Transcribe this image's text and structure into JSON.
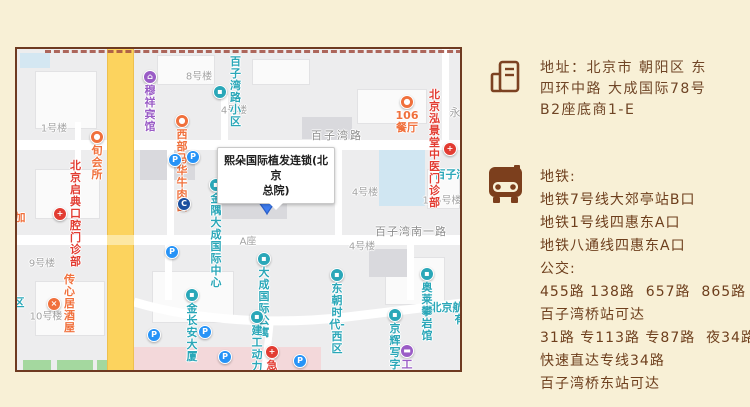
{
  "map": {
    "callout": {
      "line1": "熙朵国际植发连锁(北京",
      "line2": "总院)"
    },
    "pin_label": "1",
    "pois": [
      {
        "name": "muxiang-hotel",
        "icon": "hotel-icon",
        "glyph": "⌂",
        "color": "#9a5cc6",
        "x": 133,
        "y": 28,
        "label": "穆祥宾馆",
        "label_pos": "below",
        "label_color": "#9a5cc6"
      },
      {
        "name": "baiziwanlu-xiaoqu",
        "icon": "residence-icon",
        "glyph": "▪",
        "color": "#2aa7b8",
        "x": 203,
        "y": 43,
        "label": "百子湾路小区",
        "label_pos": "right",
        "label_color": "#2aa7b8"
      },
      {
        "name": "restaurant-106",
        "icon": "restaurant-icon",
        "glyph": "●",
        "color": "#f0703c",
        "x": 390,
        "y": 53,
        "label": "106餐厅",
        "label_pos": "below",
        "label_color": "#f0703c"
      },
      {
        "name": "xibu-mahua-noodle",
        "icon": "restaurant-icon",
        "glyph": "●",
        "color": "#f0703c",
        "x": 165,
        "y": 72,
        "label": "西部马华牛肉面",
        "label_pos": "below",
        "label_color": "#f0703c"
      },
      {
        "name": "xun-club",
        "icon": "leisure-icon",
        "glyph": "●",
        "color": "#f0703c",
        "x": 80,
        "y": 88,
        "label": "旬会所",
        "label_pos": "below",
        "label_color": "#f0703c"
      },
      {
        "name": "hongjingtang-clinic",
        "icon": "hospital-icon",
        "glyph": "+",
        "color": "#e23c32",
        "x": 433,
        "y": 100,
        "label": "北京泓景堂\n中医门诊部",
        "label_pos": "left",
        "label_color": "#e23c32"
      },
      {
        "name": "jinyu-dacheng-center",
        "icon": "mall-icon",
        "glyph": "▪",
        "color": "#2aa7b8",
        "x": 199,
        "y": 136,
        "label": "金隅大成\n国际中心",
        "label_pos": "below",
        "label_color": "#2aa7b8"
      },
      {
        "name": "bank-poi",
        "icon": "bank-icon",
        "glyph": "C",
        "color": "#1b4f9e",
        "x": 167,
        "y": 155,
        "label": "",
        "label_pos": "below",
        "label_color": "#1b4f9e"
      },
      {
        "name": "qidian-dental-clinic",
        "icon": "hospital-icon",
        "glyph": "+",
        "color": "#e23c32",
        "x": 43,
        "y": 165,
        "label": "北京启典\n口腔门诊部",
        "label_pos": "right",
        "label_color": "#e23c32"
      },
      {
        "name": "chuanxinju-izakaya",
        "icon": "restaurant-icon",
        "glyph": "×",
        "color": "#f0703c",
        "x": 37,
        "y": 255,
        "label": "传心居酒屋",
        "label_pos": "right",
        "label_color": "#f0703c"
      },
      {
        "name": "jinchangan-tower",
        "icon": "building-poi-icon",
        "glyph": "▪",
        "color": "#2aa7b8",
        "x": 175,
        "y": 246,
        "label": "金长安大厦",
        "label_pos": "below",
        "label_color": "#2aa7b8"
      },
      {
        "name": "dacheng-apartment",
        "icon": "building-poi-icon",
        "glyph": "▪",
        "color": "#2aa7b8",
        "x": 247,
        "y": 210,
        "label": "大成国际公寓",
        "label_pos": "below",
        "label_color": "#2aa7b8"
      },
      {
        "name": "dongchao-times-west",
        "icon": "building-poi-icon",
        "glyph": "▪",
        "color": "#2aa7b8",
        "x": 320,
        "y": 226,
        "label": "东朝时代-西区",
        "label_pos": "below",
        "label_color": "#2aa7b8"
      },
      {
        "name": "aolai-climbing-hall",
        "icon": "sport-icon",
        "glyph": "▪",
        "color": "#2aa7b8",
        "x": 410,
        "y": 225,
        "label": "奥莱攀岩馆",
        "label_pos": "below",
        "label_color": "#2aa7b8"
      },
      {
        "name": "jianggong-dongliyuan",
        "icon": "building-poi-icon",
        "glyph": "▪",
        "color": "#2aa7b8",
        "x": 240,
        "y": 268,
        "label": "建工动力苑",
        "label_pos": "below",
        "label_color": "#2aa7b8"
      },
      {
        "name": "jinghui-office",
        "icon": "building-poi-icon",
        "glyph": "▪",
        "color": "#2aa7b8",
        "x": 378,
        "y": 266,
        "label": "京辉写字楼",
        "label_pos": "below",
        "label_color": "#2aa7b8"
      },
      {
        "name": "gongyou-market",
        "icon": "shop-icon",
        "glyph": "▬",
        "color": "#9a5cc6",
        "x": 390,
        "y": 302,
        "label": "工友超市",
        "label_pos": "below",
        "label_color": "#9a5cc6"
      },
      {
        "name": "emergency-poi",
        "icon": "emergency-icon",
        "glyph": "+",
        "color": "#e23c32",
        "x": 255,
        "y": 303,
        "label": "急诊",
        "label_pos": "below",
        "label_color": "#e23c32"
      },
      {
        "name": "parking-1",
        "icon": "parking-icon",
        "glyph": "P",
        "color": "#2693f7",
        "x": 158,
        "y": 111,
        "label": "",
        "label_pos": "below",
        "label_color": ""
      },
      {
        "name": "parking-2",
        "icon": "parking-icon",
        "glyph": "P",
        "color": "#2693f7",
        "x": 176,
        "y": 108,
        "label": "",
        "label_pos": "below",
        "label_color": ""
      },
      {
        "name": "parking-3",
        "icon": "parking-icon",
        "glyph": "P",
        "color": "#2693f7",
        "x": 155,
        "y": 203,
        "label": "",
        "label_pos": "below",
        "label_color": ""
      },
      {
        "name": "parking-4",
        "icon": "parking-icon",
        "glyph": "P",
        "color": "#2693f7",
        "x": 137,
        "y": 286,
        "label": "",
        "label_pos": "below",
        "label_color": ""
      },
      {
        "name": "parking-5",
        "icon": "parking-icon",
        "glyph": "P",
        "color": "#2693f7",
        "x": 188,
        "y": 283,
        "label": "",
        "label_pos": "below",
        "label_color": ""
      },
      {
        "name": "parking-6",
        "icon": "parking-icon",
        "glyph": "P",
        "color": "#2693f7",
        "x": 208,
        "y": 308,
        "label": "",
        "label_pos": "below",
        "label_color": ""
      },
      {
        "name": "parking-7",
        "icon": "parking-icon",
        "glyph": "P",
        "color": "#2693f7",
        "x": 283,
        "y": 312,
        "label": "",
        "label_pos": "below",
        "label_color": ""
      }
    ],
    "texts": [
      {
        "name": "building-label",
        "text": "8号楼",
        "x": 182,
        "y": 26,
        "color": "#a3a3a3",
        "size": 10
      },
      {
        "name": "building-label",
        "text": "4号楼",
        "x": 217,
        "y": 60,
        "color": "#a3a3a3",
        "size": 10
      },
      {
        "name": "building-label",
        "text": "1号楼",
        "x": 37,
        "y": 78,
        "color": "#a3a3a3",
        "size": 10
      },
      {
        "name": "building-label",
        "text": "9号楼",
        "x": 25,
        "y": 213,
        "color": "#a3a3a3",
        "size": 10
      },
      {
        "name": "building-label",
        "text": "10号楼",
        "x": 29,
        "y": 266,
        "color": "#a3a3a3",
        "size": 10
      },
      {
        "name": "building-label",
        "text": "4号楼",
        "x": 348,
        "y": 142,
        "color": "#a3a3a3",
        "size": 10
      },
      {
        "name": "building-label",
        "text": "105号楼",
        "x": 425,
        "y": 150,
        "color": "#a3a3a3",
        "size": 10
      },
      {
        "name": "building-label",
        "text": "4号楼",
        "x": 345,
        "y": 196,
        "color": "#a3a3a3",
        "size": 10
      },
      {
        "name": "building-label",
        "text": "A座",
        "x": 231,
        "y": 191,
        "color": "#a3a3a3",
        "size": 10
      },
      {
        "name": "building-label",
        "text": "永",
        "x": 438,
        "y": 63,
        "color": "#a3a3a3",
        "size": 11
      },
      {
        "name": "road-label",
        "text": "百子湾路",
        "x": 320,
        "y": 86,
        "color": "#8b8b8b",
        "size": 11,
        "spacing": 2
      },
      {
        "name": "road-label",
        "text": "百子湾南一路",
        "x": 394,
        "y": 182,
        "color": "#8b8b8b",
        "size": 11,
        "spacing": 1
      },
      {
        "name": "poi-label-cut",
        "text": "百子湾",
        "x": 434,
        "y": 125,
        "color": "#2aa7b8",
        "size": 11,
        "bold": true
      },
      {
        "name": "poi-label-cut",
        "text": "北京航",
        "x": 430,
        "y": 258,
        "color": "#2aa7b8",
        "size": 11,
        "bold": true
      },
      {
        "name": "poi-label-cut",
        "text": "有",
        "x": 443,
        "y": 270,
        "color": "#2aa7b8",
        "size": 11,
        "bold": true
      },
      {
        "name": "poi-label-cut",
        "text": "区",
        "x": 2,
        "y": 253,
        "color": "#2aa7b8",
        "size": 11,
        "bold": true
      },
      {
        "name": "poi-label-cut",
        "text": "加",
        "x": 3,
        "y": 168,
        "color": "#f0703c",
        "size": 11,
        "bold": true
      }
    ]
  },
  "info": {
    "address_lines": [
      "地址：北京市 朝阳区 东",
      "四环中路 大成国际78号",
      "B2座底商1-E"
    ],
    "transit_lines": [
      "地铁:",
      "地铁7号线大郊亭站B口",
      "地铁1号线四惠东A口",
      "地铁八通线四惠东A口",
      "公交:",
      "455路 138路  657路  865路",
      "百子湾桥站可达",
      "31路 专113路 专87路  夜34路",
      "快速直达专线34路",
      "百子湾桥东站可达"
    ],
    "accent_color": "#6e3f1d"
  }
}
